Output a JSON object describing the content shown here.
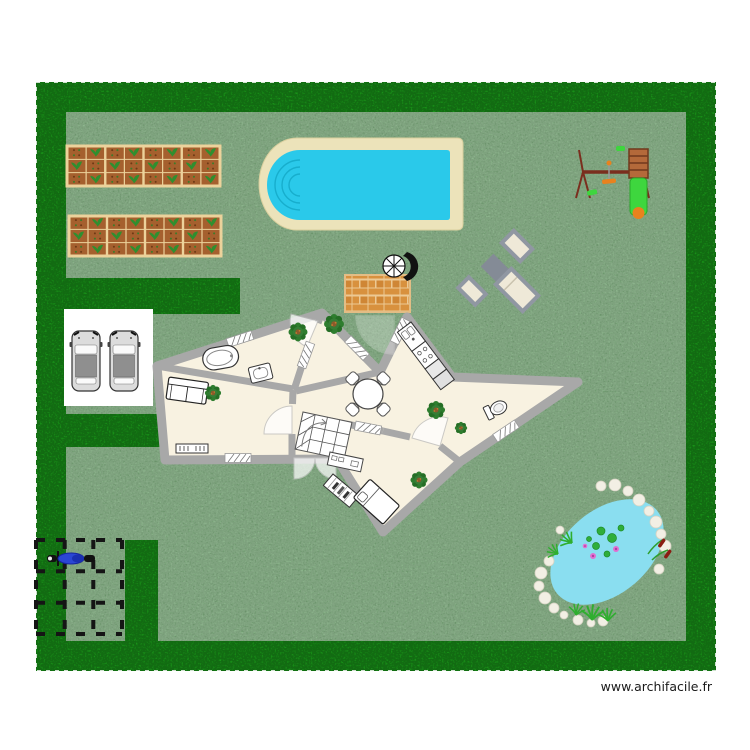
{
  "watermark": {
    "text": "www.archifacile.fr"
  },
  "colors": {
    "page": "#ffffff",
    "lawn": "#79aa79",
    "hedge": "#1a9a1a",
    "floor": "#f8f2e1",
    "wall": "#a8a8a8",
    "pool_water": "#2ac9ea",
    "pool_deck": "#ece3ba",
    "pond": "#8adef0",
    "terrace_brick": "#d8913e",
    "terrace_gap": "#ecc994",
    "soil": "#a5602e",
    "soil_frame": "#ecd29b",
    "slide": "#3ed63e",
    "play_wood": "#7a2e1e",
    "ladder": "#b4693a",
    "accent_orange": "#e8821e",
    "lounger_frame": "#9097a2",
    "lounger_pad": "#efe9d8",
    "moto": "#2b46d4",
    "stone": "#f2efe4",
    "car_body": "#dcdcdc",
    "car_roof": "#8f8f8f",
    "watermark_text": "#1a1a1a"
  },
  "scene": {
    "garden_beds": [
      {
        "x": 67,
        "y": 146,
        "w": 153,
        "h": 40,
        "cols": 8
      },
      {
        "x": 69,
        "y": 216,
        "w": 152,
        "h": 40,
        "cols": 8
      }
    ],
    "plants": [
      [
        298,
        332,
        1.0
      ],
      [
        334,
        324,
        1.05
      ],
      [
        213,
        393,
        0.85
      ],
      [
        436,
        410,
        0.95
      ],
      [
        461,
        428,
        0.65
      ],
      [
        419,
        480,
        0.9
      ]
    ],
    "cars": [
      [
        72,
        329
      ],
      [
        110,
        329
      ]
    ],
    "stones": [
      [
        601,
        486,
        5
      ],
      [
        615,
        485,
        6
      ],
      [
        628,
        491,
        5
      ],
      [
        639,
        500,
        6
      ],
      [
        649,
        511,
        5
      ],
      [
        656,
        522,
        6
      ],
      [
        661,
        534,
        5
      ],
      [
        665,
        546,
        6
      ],
      [
        659,
        569,
        5
      ],
      [
        549,
        561,
        5
      ],
      [
        541,
        573,
        6
      ],
      [
        539,
        586,
        5
      ],
      [
        545,
        598,
        6
      ],
      [
        554,
        608,
        5
      ],
      [
        564,
        615,
        4
      ],
      [
        578,
        620,
        5
      ],
      [
        591,
        623,
        4
      ],
      [
        603,
        621,
        5
      ],
      [
        560,
        530,
        4
      ]
    ],
    "lily_pads": [
      [
        601,
        531,
        4
      ],
      [
        612,
        538,
        4.5
      ],
      [
        596,
        546,
        3.5
      ],
      [
        621,
        528,
        3
      ],
      [
        607,
        554,
        3
      ],
      [
        589,
        539,
        2.5
      ]
    ],
    "flowers": [
      [
        593,
        556,
        3
      ],
      [
        616,
        549,
        3
      ],
      [
        585,
        546,
        2.3
      ]
    ]
  }
}
